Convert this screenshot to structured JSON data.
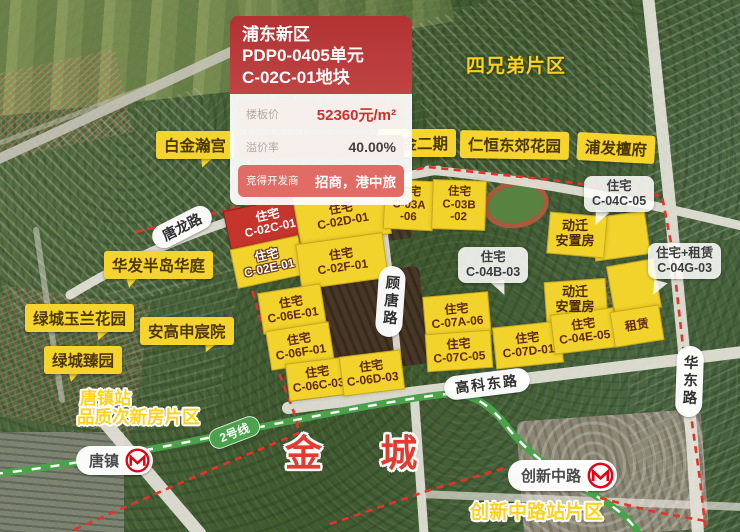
{
  "colors": {
    "label_yellow": "#f6d42e",
    "parcel_yellow": "#f2d32b",
    "parcel_red": "#c5352b",
    "boundary_red": "#e5332a",
    "metro_green": "#4ba24b",
    "metro_logo_red": "#e60012",
    "card_header_red": "#b23232",
    "price_red": "#cf2f28"
  },
  "info_card": {
    "title_lines": [
      "浦东新区",
      "PDP0-0405单元",
      "C-02C-01地块"
    ],
    "metrics": [
      {
        "label": "楼板价",
        "value": "52360元/m²"
      },
      {
        "label": "溢价率",
        "value": "40.00%"
      }
    ],
    "developer": {
      "label": "竞得开发商",
      "value": "招商，港中旅"
    }
  },
  "area_texts": {
    "si_xiongdi": "四兄弟片区",
    "tangzhen_line1": "唐镇站",
    "tangzhen_line2": "品质次新房片区",
    "chuangxin": "创新中路站片区",
    "jincheng": "金 城"
  },
  "community_labels": [
    "白金瀚宫",
    "紫金二期",
    "仁恒东郊花园",
    "浦发檀府",
    "华发半岛华庭",
    "绿城玉兰花园",
    "安高申宸院",
    "绿城臻园"
  ],
  "parcels": [
    {
      "id": "C-02C-01",
      "lines": [
        "住宅",
        "C-02C-01"
      ]
    },
    {
      "id": "C-02D-01",
      "lines": [
        "住宅",
        "C-02D-01"
      ]
    },
    {
      "id": "C-02E-01",
      "lines": [
        "住宅",
        "C-02E-01"
      ]
    },
    {
      "id": "C-02F-01",
      "lines": [
        "住宅",
        "C-02F-01"
      ]
    },
    {
      "id": "C-03A-06",
      "lines": [
        "住宅",
        "C-03A",
        "-06"
      ]
    },
    {
      "id": "C-03B-02",
      "lines": [
        "住宅",
        "C-03B",
        "-02"
      ]
    },
    {
      "id": "C-06E-01",
      "lines": [
        "住宅",
        "C-06E-01"
      ]
    },
    {
      "id": "C-06F-01",
      "lines": [
        "住宅",
        "C-06F-01"
      ]
    },
    {
      "id": "C-06C-03",
      "lines": [
        "住宅",
        "C-06C-03"
      ]
    },
    {
      "id": "C-06D-03",
      "lines": [
        "住宅",
        "C-06D-03"
      ]
    },
    {
      "id": "C-07A-06",
      "lines": [
        "住宅",
        "C-07A-06"
      ]
    },
    {
      "id": "C-07C-05",
      "lines": [
        "住宅",
        "C-07C-05"
      ]
    },
    {
      "id": "C-07D-01",
      "lines": [
        "住宅",
        "C-07D-01"
      ]
    },
    {
      "id": "C-04E-05",
      "lines": [
        "住宅",
        "C-04E-05"
      ]
    },
    {
      "id": "rental",
      "lines": [
        "租赁"
      ]
    }
  ],
  "bubbles": [
    {
      "lines": [
        "住宅",
        "C-04C-05"
      ]
    },
    {
      "lines": [
        "住宅",
        "C-04B-03"
      ]
    },
    {
      "lines": [
        "住宅+租赁",
        "C-04G-03"
      ]
    }
  ],
  "resettlement": [
    {
      "lines": [
        "动迁",
        "安置房"
      ]
    },
    {
      "lines": [
        "动迁",
        "安置房"
      ]
    }
  ],
  "roads": {
    "tanglong": "唐龙路",
    "gutang": "顾唐路",
    "gaokedong": "高科东路",
    "huadong": "华东路"
  },
  "metro": {
    "line_badge": "2号线",
    "stations": [
      "唐镇",
      "创新中路"
    ]
  }
}
